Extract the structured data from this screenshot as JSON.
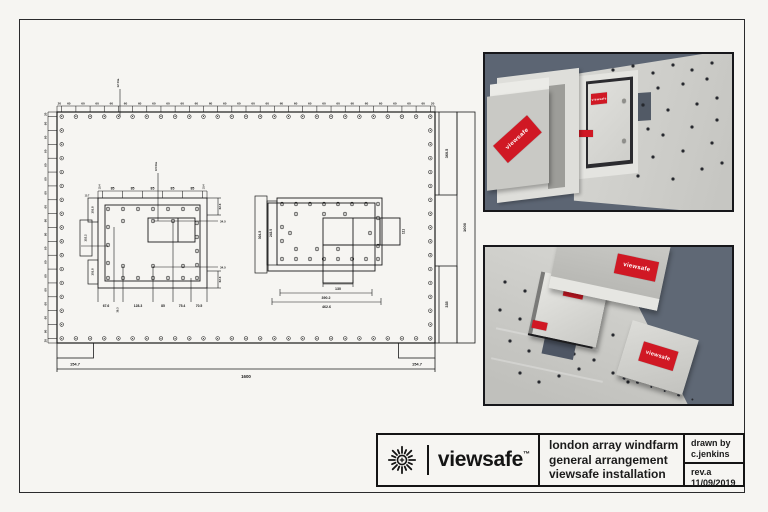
{
  "title_block": {
    "brand": "viewsafe",
    "brand_tm": "™",
    "project_line1": "london array windfarm",
    "project_line2": "general arrangement",
    "project_line3": "viewsafe installation",
    "drawn_by_label": "drawn by",
    "drawn_by_value": "c.jenkins",
    "revision": "rev.a",
    "date": "11/09/2019"
  },
  "renders": {
    "label_text": "viewsafe"
  },
  "colors": {
    "paper": "#f6f5f2",
    "ink": "#1b1b1b",
    "render_background_top": "#5c6573",
    "render_background_bottom": "#5f6875",
    "panel_grey": "#d3d3cf",
    "brand_red": "#d01824"
  },
  "drawing": {
    "leader_top": "12 Dia",
    "top_chain": [
      "20",
      "60",
      "60",
      "60",
      "60",
      "60",
      "60",
      "60",
      "60",
      "60",
      "60",
      "60",
      "60",
      "60",
      "60",
      "60",
      "60",
      "60",
      "60",
      "60",
      "60",
      "60",
      "60",
      "60",
      "60",
      "60",
      "60",
      "20"
    ],
    "left_chain": [
      "20",
      "60",
      "60",
      "60",
      "60",
      "60",
      "60",
      "60",
      "60",
      "60",
      "60",
      "60",
      "60",
      "60",
      "60",
      "60",
      "60",
      "20"
    ],
    "right_dims": {
      "segment_top": "360.5",
      "overall": "1000",
      "segment_bottom": "335"
    },
    "bottom_dims": {
      "left": "154.7",
      "overall": "1600",
      "right": "154.7"
    },
    "panel_a": {
      "leader": "9.5 Dia",
      "top_chain": [
        "19.4",
        "85",
        "85",
        "85",
        "85",
        "85",
        "19.4"
      ],
      "left_dims": [
        "15.7",
        "101.8",
        "152.2",
        "101.8"
      ],
      "right_dims": [
        "62.6",
        "34.5",
        "34.5",
        "62.6"
      ],
      "bottom_dims": [
        "67.6",
        "39.3",
        "128.3",
        "85",
        "75.4",
        "70.5"
      ]
    },
    "panel_b": {
      "left_dims": [
        "304.5",
        "243.5"
      ],
      "right_dim": "111",
      "bottom_dims": [
        "130",
        "390.2",
        "462.6"
      ]
    }
  }
}
